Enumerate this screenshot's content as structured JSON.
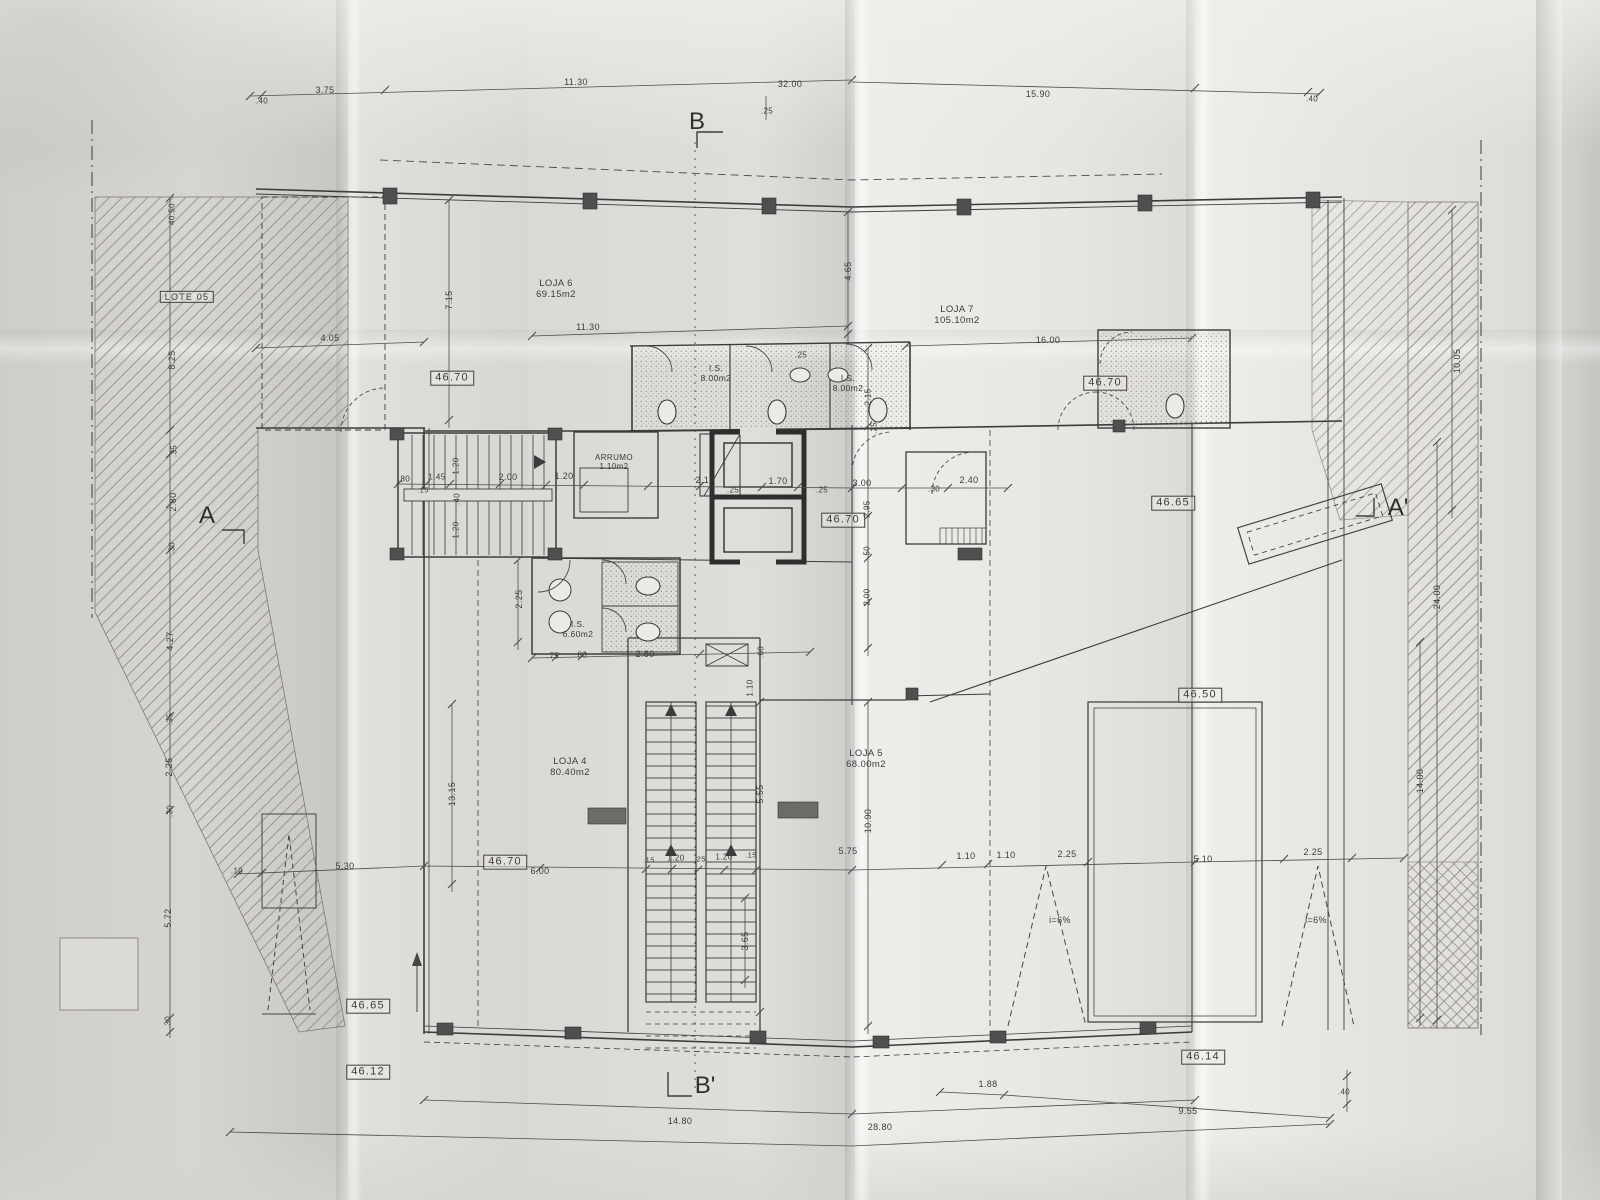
{
  "colors": {
    "paper": "#dedcd8",
    "ink": "#3c3c3c"
  },
  "rooms": [
    {
      "label": "LOJA 6",
      "area": "69.15m2"
    },
    {
      "label": "LOJA 7",
      "area": "105.10m2"
    },
    {
      "label": "LOJA 4",
      "area": "80.40m2"
    },
    {
      "label": "LOJA 5",
      "area": "68.00m2"
    },
    {
      "label": "I.S.",
      "area": "8.00m2"
    },
    {
      "label": "I.S.",
      "area": "8.00m2"
    },
    {
      "label": "I.S.",
      "area": "6.60m2"
    },
    {
      "label": "ARRUMO",
      "area": "1.10m2"
    }
  ],
  "elevations": [
    "46.70",
    "46.70",
    "46.70",
    "46.70",
    "46.65",
    "46.65",
    "46.50",
    "46.14",
    "46.12"
  ],
  "sections": [
    "A",
    "A'",
    "B",
    "B'"
  ],
  "annotations": [
    {
      "n": "section-marker-b",
      "t": "B",
      "x": 697,
      "y": 122,
      "fs": 24,
      "cls": "sec"
    },
    {
      "n": "section-marker-b-prime",
      "t": "B'",
      "x": 705,
      "y": 1086,
      "fs": 24,
      "cls": "sec"
    },
    {
      "n": "section-marker-a",
      "t": "A",
      "x": 207,
      "y": 516,
      "fs": 24,
      "cls": "sec"
    },
    {
      "n": "section-marker-a-prime",
      "t": "A'",
      "x": 1398,
      "y": 508,
      "fs": 24,
      "cls": "sec"
    },
    {
      "n": "lot-label",
      "t": "LOTE 05",
      "x": 187,
      "y": 297,
      "fs": 9,
      "boxed": true
    },
    {
      "n": "room-label-loja-6",
      "t": "LOJA 6\n69.15m2",
      "x": 556,
      "y": 290,
      "fs": 9.5
    },
    {
      "n": "room-label-loja-7",
      "t": "LOJA 7\n105.10m2",
      "x": 957,
      "y": 316,
      "fs": 9.5
    },
    {
      "n": "room-label-loja-4",
      "t": "LOJA 4\n80.40m2",
      "x": 570,
      "y": 768,
      "fs": 9.5
    },
    {
      "n": "room-label-loja-5",
      "t": "LOJA 5\n68.00m2",
      "x": 866,
      "y": 760,
      "fs": 9.5
    },
    {
      "n": "room-label-is-1",
      "t": "I.S.\n8.00m2",
      "x": 716,
      "y": 374,
      "fs": 8.5
    },
    {
      "n": "room-label-is-2",
      "t": "I.S.\n8.00m2",
      "x": 848,
      "y": 384,
      "fs": 8.5
    },
    {
      "n": "room-label-is-3",
      "t": "I.S.\n6.60m2",
      "x": 578,
      "y": 630,
      "fs": 8.5
    },
    {
      "n": "room-label-arrumo",
      "t": "ARRUMO\n1.10m2",
      "x": 614,
      "y": 462,
      "fs": 8
    },
    {
      "n": "elevation-box",
      "t": "46.70",
      "x": 452,
      "y": 378,
      "fs": 11,
      "boxed": true
    },
    {
      "n": "elevation-box",
      "t": "46.70",
      "x": 1105,
      "y": 383,
      "fs": 11,
      "boxed": true
    },
    {
      "n": "elevation-box",
      "t": "46.70",
      "x": 843,
      "y": 520,
      "fs": 11,
      "boxed": true
    },
    {
      "n": "elevation-box",
      "t": "46.70",
      "x": 505,
      "y": 862,
      "fs": 11,
      "boxed": true
    },
    {
      "n": "elevation-box",
      "t": "46.65",
      "x": 1173,
      "y": 503,
      "fs": 11,
      "boxed": true
    },
    {
      "n": "elevation-box",
      "t": "46.65",
      "x": 368,
      "y": 1006,
      "fs": 11,
      "boxed": true
    },
    {
      "n": "elevation-box",
      "t": "46.50",
      "x": 1200,
      "y": 695,
      "fs": 11,
      "boxed": true
    },
    {
      "n": "elevation-box",
      "t": "46.12",
      "x": 368,
      "y": 1072,
      "fs": 11,
      "boxed": true
    },
    {
      "n": "elevation-box",
      "t": "46.14",
      "x": 1203,
      "y": 1057,
      "fs": 11,
      "boxed": true
    },
    {
      "n": "slope-label",
      "t": "i=6%",
      "x": 1060,
      "y": 920,
      "fs": 9
    },
    {
      "n": "slope-label",
      "t": "i=6%",
      "x": 1316,
      "y": 920,
      "fs": 9
    },
    {
      "n": "dim-label",
      "t": ".40",
      "x": 262,
      "y": 101,
      "fs": 8
    },
    {
      "n": "dim-label",
      "t": "3.75",
      "x": 325,
      "y": 90,
      "fs": 9
    },
    {
      "n": "dim-label",
      "t": "11.30",
      "x": 576,
      "y": 82,
      "fs": 9
    },
    {
      "n": "dim-label",
      "t": "32.00",
      "x": 790,
      "y": 84,
      "fs": 9
    },
    {
      "n": "dim-label",
      "t": ".25",
      "x": 767,
      "y": 111,
      "fs": 8
    },
    {
      "n": "dim-label",
      "t": "15.90",
      "x": 1038,
      "y": 94,
      "fs": 9
    },
    {
      "n": "dim-label",
      "t": ".40",
      "x": 1312,
      "y": 99,
      "fs": 8
    },
    {
      "n": "dim-label",
      "t": "40.50",
      "x": 172,
      "y": 214,
      "r": -90,
      "fs": 8
    },
    {
      "n": "dim-label",
      "t": "8.25",
      "x": 172,
      "y": 360,
      "r": -90,
      "fs": 9
    },
    {
      "n": "dim-label",
      "t": ".35",
      "x": 174,
      "y": 451,
      "r": -90,
      "fs": 8
    },
    {
      "n": "dim-label",
      "t": "2.80",
      "x": 173,
      "y": 502,
      "r": -90,
      "fs": 9
    },
    {
      "n": "dim-label",
      "t": ".30",
      "x": 172,
      "y": 548,
      "r": -90,
      "fs": 8
    },
    {
      "n": "dim-label",
      "t": "4.27",
      "x": 170,
      "y": 641,
      "r": -90,
      "fs": 9
    },
    {
      "n": "dim-label",
      "t": ".35",
      "x": 170,
      "y": 719,
      "r": -90,
      "fs": 8
    },
    {
      "n": "dim-label",
      "t": "2.25",
      "x": 169,
      "y": 767,
      "r": -90,
      "fs": 9
    },
    {
      "n": "dim-label",
      "t": ".30",
      "x": 170,
      "y": 811,
      "r": -90,
      "fs": 8
    },
    {
      "n": "dim-label",
      "t": "5.72",
      "x": 168,
      "y": 918,
      "r": -90,
      "fs": 9
    },
    {
      "n": "dim-label",
      "t": ".30",
      "x": 168,
      "y": 1022,
      "r": -90,
      "fs": 8
    },
    {
      "n": "dim-label",
      "t": "4.05",
      "x": 330,
      "y": 338,
      "fs": 9
    },
    {
      "n": "dim-label",
      "t": "7.15",
      "x": 449,
      "y": 300,
      "r": -90,
      "fs": 9
    },
    {
      "n": "dim-label",
      "t": "11.30",
      "x": 588,
      "y": 327,
      "fs": 9
    },
    {
      "n": "dim-label",
      "t": "16.00",
      "x": 1048,
      "y": 340,
      "fs": 9
    },
    {
      "n": "dim-label",
      "t": "4.65",
      "x": 848,
      "y": 271,
      "r": -90,
      "fs": 9
    },
    {
      "n": "dim-label",
      "t": ".25",
      "x": 801,
      "y": 355,
      "fs": 8
    },
    {
      "n": "dim-label",
      "t": "2.15",
      "x": 868,
      "y": 397,
      "r": -90,
      "fs": 8
    },
    {
      "n": "dim-label",
      "t": ".25",
      "x": 874,
      "y": 428,
      "r": -90,
      "fs": 8
    },
    {
      "n": "dim-label",
      "t": ".80",
      "x": 404,
      "y": 479,
      "fs": 8
    },
    {
      "n": "dim-label",
      "t": "1.45",
      "x": 437,
      "y": 477,
      "fs": 8
    },
    {
      "n": "dim-label",
      "t": ".15",
      "x": 423,
      "y": 491,
      "fs": 7.5
    },
    {
      "n": "dim-label",
      "t": "1.20",
      "x": 456,
      "y": 466,
      "r": -90,
      "fs": 8
    },
    {
      "n": "dim-label",
      "t": ".40",
      "x": 457,
      "y": 499,
      "r": -90,
      "fs": 8
    },
    {
      "n": "dim-label",
      "t": "1.20",
      "x": 456,
      "y": 530,
      "r": -90,
      "fs": 8
    },
    {
      "n": "dim-label",
      "t": "2.00",
      "x": 508,
      "y": 477,
      "fs": 9
    },
    {
      "n": "dim-label",
      "t": "1.20",
      "x": 564,
      "y": 476,
      "fs": 9
    },
    {
      "n": "dim-label",
      "t": "2.10",
      "x": 705,
      "y": 480,
      "fs": 9
    },
    {
      "n": "dim-label",
      "t": ".25",
      "x": 733,
      "y": 490,
      "fs": 8
    },
    {
      "n": "dim-label",
      "t": "1.70",
      "x": 778,
      "y": 481,
      "fs": 9
    },
    {
      "n": "dim-label",
      "t": ".25",
      "x": 822,
      "y": 490,
      "fs": 8
    },
    {
      "n": "dim-label",
      "t": "3.00",
      "x": 862,
      "y": 483,
      "fs": 9
    },
    {
      "n": "dim-label",
      "t": ".30",
      "x": 934,
      "y": 489,
      "fs": 8
    },
    {
      "n": "dim-label",
      "t": "2.40",
      "x": 969,
      "y": 480,
      "fs": 9
    },
    {
      "n": "dim-label",
      "t": "2.95",
      "x": 867,
      "y": 509,
      "r": -90,
      "fs": 8
    },
    {
      "n": "dim-label",
      "t": ".50",
      "x": 867,
      "y": 552,
      "r": -90,
      "fs": 8
    },
    {
      "n": "dim-label",
      "t": "2.00",
      "x": 867,
      "y": 597,
      "r": -90,
      "fs": 8
    },
    {
      "n": "dim-label",
      "t": "2.25",
      "x": 519,
      "y": 599,
      "r": -90,
      "fs": 9
    },
    {
      "n": "dim-label",
      "t": ".75",
      "x": 553,
      "y": 656,
      "fs": 8
    },
    {
      "n": "dim-label",
      "t": ".80",
      "x": 581,
      "y": 655,
      "fs": 8
    },
    {
      "n": "dim-label",
      "t": "2.80",
      "x": 645,
      "y": 654,
      "fs": 9
    },
    {
      "n": "dim-label",
      "t": ".60",
      "x": 761,
      "y": 652,
      "r": -90,
      "fs": 8
    },
    {
      "n": "dim-label",
      "t": "1.10",
      "x": 750,
      "y": 688,
      "r": -90,
      "fs": 8
    },
    {
      "n": "dim-label",
      "t": ".10",
      "x": 237,
      "y": 871,
      "fs": 8
    },
    {
      "n": "dim-label",
      "t": "5.30",
      "x": 345,
      "y": 866,
      "fs": 9
    },
    {
      "n": "dim-label",
      "t": "6.00",
      "x": 540,
      "y": 871,
      "fs": 9
    },
    {
      "n": "dim-label",
      "t": "13.15",
      "x": 452,
      "y": 794,
      "r": -90,
      "fs": 9
    },
    {
      "n": "dim-label",
      "t": ".15",
      "x": 649,
      "y": 861,
      "fs": 7.5
    },
    {
      "n": "dim-label",
      "t": "1.20",
      "x": 676,
      "y": 858,
      "fs": 8
    },
    {
      "n": "dim-label",
      "t": ".25",
      "x": 700,
      "y": 860,
      "fs": 7.5
    },
    {
      "n": "dim-label",
      "t": "1.20",
      "x": 724,
      "y": 857,
      "fs": 8
    },
    {
      "n": "dim-label",
      "t": ".15",
      "x": 751,
      "y": 856,
      "fs": 7.5
    },
    {
      "n": "dim-label",
      "t": "5.75",
      "x": 848,
      "y": 851,
      "fs": 9
    },
    {
      "n": "dim-label",
      "t": "5.55",
      "x": 760,
      "y": 794,
      "r": -90,
      "fs": 9
    },
    {
      "n": "dim-label",
      "t": "10.90",
      "x": 868,
      "y": 821,
      "r": -90,
      "fs": 9
    },
    {
      "n": "dim-label",
      "t": "3.65",
      "x": 745,
      "y": 941,
      "r": -90,
      "fs": 9
    },
    {
      "n": "dim-label",
      "t": "1.10",
      "x": 966,
      "y": 856,
      "fs": 9
    },
    {
      "n": "dim-label",
      "t": "1.10",
      "x": 1006,
      "y": 855,
      "fs": 9
    },
    {
      "n": "dim-label",
      "t": "2.25",
      "x": 1067,
      "y": 854,
      "fs": 9
    },
    {
      "n": "dim-label",
      "t": "5.10",
      "x": 1203,
      "y": 859,
      "fs": 9
    },
    {
      "n": "dim-label",
      "t": "2.25",
      "x": 1313,
      "y": 852,
      "fs": 9
    },
    {
      "n": "dim-label",
      "t": "14.80",
      "x": 680,
      "y": 1121,
      "fs": 9
    },
    {
      "n": "dim-label",
      "t": "28.80",
      "x": 880,
      "y": 1127,
      "fs": 9
    },
    {
      "n": "dim-label",
      "t": "1.88",
      "x": 988,
      "y": 1084,
      "fs": 9
    },
    {
      "n": "dim-label",
      "t": "9.55",
      "x": 1188,
      "y": 1111,
      "fs": 9
    },
    {
      "n": "dim-label",
      "t": ".40",
      "x": 1344,
      "y": 1092,
      "fs": 8
    },
    {
      "n": "dim-label",
      "t": "24.00",
      "x": 1437,
      "y": 597,
      "r": -90,
      "fs": 9
    },
    {
      "n": "dim-label",
      "t": "14.00",
      "x": 1420,
      "y": 781,
      "r": -90,
      "fs": 9
    },
    {
      "n": "dim-label",
      "t": "10.05",
      "x": 1457,
      "y": 361,
      "r": -90,
      "fs": 9
    }
  ]
}
